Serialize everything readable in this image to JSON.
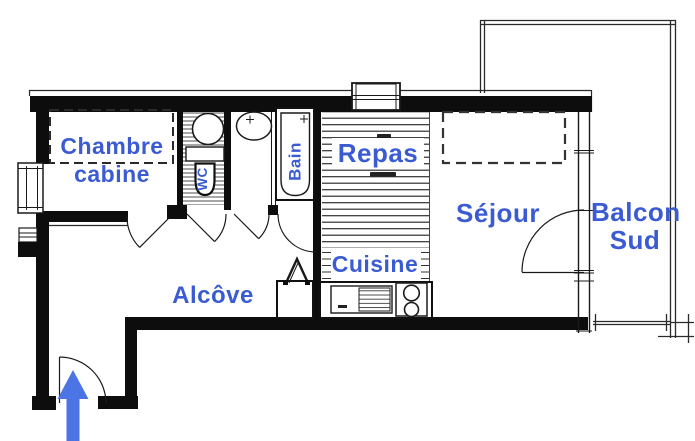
{
  "floor_plan": {
    "rooms": {
      "chambre": {
        "line1": "Chambre",
        "line2": "cabine"
      },
      "wc": {
        "label": "WC"
      },
      "bain": {
        "label": "Bain"
      },
      "repas": {
        "label": "Repas"
      },
      "cuisine": {
        "label": "Cuisine"
      },
      "sejour": {
        "label": "Séjour"
      },
      "balcon": {
        "line1": "Balcon",
        "line2": "Sud"
      },
      "alcove": {
        "label": "Alcôve"
      }
    },
    "icons": {
      "entrance_arrow_icon": "up-arrow"
    },
    "colors": {
      "label_blue": "#3B5BD3",
      "arrow_blue": "#4B74E4",
      "wall_black": "#0d0d0d"
    }
  }
}
